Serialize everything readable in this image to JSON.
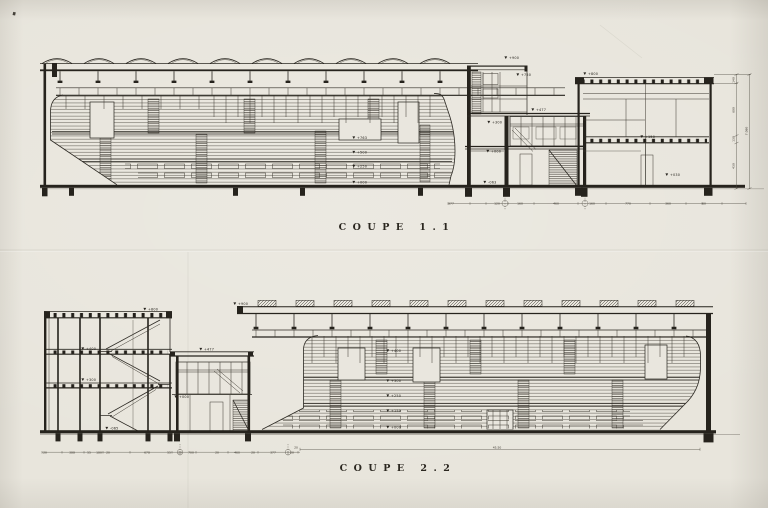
{
  "colors": {
    "paper": "#e8e5dc",
    "ink": "#26231d",
    "faint_line": "#7a756a"
  },
  "coupe1": {
    "title": "COUPE  1.1",
    "annotations": [
      {
        "t": "+900",
        "x": 509,
        "y": 59
      },
      {
        "t": "+750",
        "x": 521,
        "y": 76
      },
      {
        "t": "+800",
        "x": 588,
        "y": 75
      },
      {
        "t": "+477",
        "x": 536,
        "y": 111
      },
      {
        "t": "+763",
        "x": 357,
        "y": 139
      },
      {
        "t": "+500",
        "x": 357,
        "y": 153.5
      },
      {
        "t": "+250",
        "x": 357,
        "y": 167.5
      },
      {
        "t": "+000",
        "x": 357,
        "y": 183.5
      },
      {
        "t": "+300",
        "x": 492,
        "y": 123.5
      },
      {
        "t": "+000",
        "x": 491,
        "y": 152.5
      },
      {
        "t": "-063",
        "x": 488,
        "y": 183.5
      },
      {
        "t": "+150",
        "x": 645,
        "y": 138
      },
      {
        "t": "+030",
        "x": 670,
        "y": 176
      }
    ],
    "dims_bottom": [
      {
        "t": "377",
        "x": 451,
        "y": 204.6
      },
      {
        "t": "120",
        "x": 497,
        "y": 204.6
      },
      {
        "t": "160",
        "x": 520,
        "y": 204.6
      },
      {
        "t": "460",
        "x": 556,
        "y": 204.6
      },
      {
        "t": "160",
        "x": 592,
        "y": 204.6
      },
      {
        "t": "770",
        "x": 628,
        "y": 204.6
      },
      {
        "t": "360",
        "x": 668,
        "y": 204.6
      },
      {
        "t": "60",
        "x": 704,
        "y": 204.6
      }
    ],
    "dims_right": [
      {
        "t": "140",
        "x": 734.5,
        "y": 80
      },
      {
        "t": "600",
        "x": 734.5,
        "y": 110
      },
      {
        "t": "130",
        "x": 734.5,
        "y": 139
      },
      {
        "t": "430",
        "x": 734.5,
        "y": 166
      },
      {
        "t": "7.080",
        "x": 747.5,
        "y": 131
      }
    ]
  },
  "coupe2": {
    "title": "COUPE  2.2",
    "annotations": [
      {
        "t": "+900",
        "x": 238,
        "y": 305
      },
      {
        "t": "+800",
        "x": 148,
        "y": 310.5
      },
      {
        "t": "+400",
        "x": 86,
        "y": 350
      },
      {
        "t": "+300",
        "x": 86,
        "y": 381
      },
      {
        "t": "+477",
        "x": 204,
        "y": 350.5
      },
      {
        "t": "+000",
        "x": 179,
        "y": 398
      },
      {
        "t": "-065",
        "x": 110,
        "y": 429.5
      },
      {
        "t": "+400",
        "x": 391,
        "y": 352
      },
      {
        "t": "+300",
        "x": 391,
        "y": 382
      },
      {
        "t": "+250",
        "x": 391,
        "y": 397
      },
      {
        "t": "+150",
        "x": 391,
        "y": 412
      },
      {
        "t": "+000",
        "x": 391,
        "y": 428.5
      }
    ],
    "dims_bottom": [
      {
        "t": "20",
        "x": 45,
        "y": 453.6
      },
      {
        "t": "388",
        "x": 72,
        "y": 453.6
      },
      {
        "t": "55",
        "x": 89,
        "y": 453.6
      },
      {
        "t": "180",
        "x": 99,
        "y": 453.6
      },
      {
        "t": "20",
        "x": 108,
        "y": 453.6
      },
      {
        "t": "678",
        "x": 147,
        "y": 453.6
      },
      {
        "t": "55",
        "x": 169,
        "y": 453.6
      },
      {
        "t": "20",
        "x": 180,
        "y": 453.6
      },
      {
        "t": "700",
        "x": 191,
        "y": 453.6
      },
      {
        "t": "20",
        "x": 217,
        "y": 453.6
      },
      {
        "t": "460",
        "x": 237,
        "y": 453.6
      },
      {
        "t": "20",
        "x": 253,
        "y": 453.6
      },
      {
        "t": "377",
        "x": 273,
        "y": 453.6
      },
      {
        "t": "20",
        "x": 292,
        "y": 453.6
      }
    ],
    "dims_total": [
      {
        "t": "20",
        "x": 296,
        "y": 448.4
      },
      {
        "t": "45.50",
        "x": 497,
        "y": 448.4
      }
    ]
  }
}
